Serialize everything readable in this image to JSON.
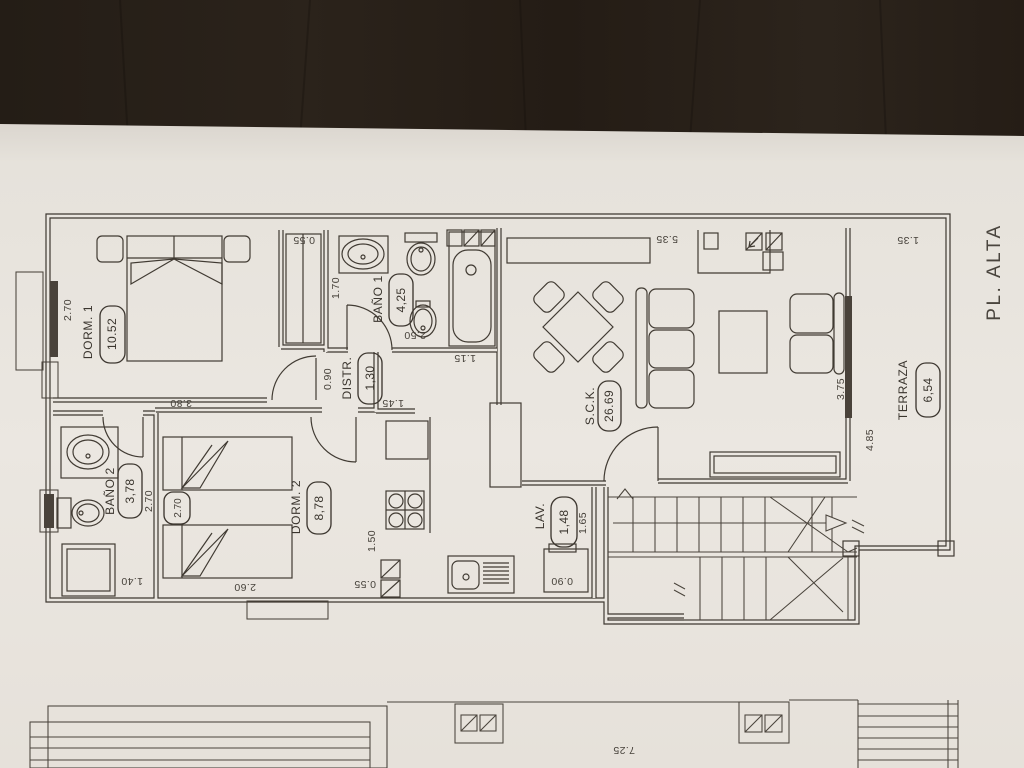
{
  "photo": {
    "desk_color": "#272019",
    "paper_color": "#e9e5df",
    "ink_color": "#3e3831"
  },
  "floor_plan": {
    "floor_label": "PL. ALTA",
    "rooms": [
      {
        "id": "dorm1",
        "name": "DORM. 1",
        "area": "10.52"
      },
      {
        "id": "bano1",
        "name": "BAÑO 1",
        "area": "4,25"
      },
      {
        "id": "distr",
        "name": "DISTR.",
        "area": "1,30"
      },
      {
        "id": "sck",
        "name": "S.C.K.",
        "area": "26.69"
      },
      {
        "id": "terraza",
        "name": "TERRAZA",
        "area": "6,54"
      },
      {
        "id": "bano2",
        "name": "BAÑO 2",
        "area": "3,78"
      },
      {
        "id": "dorm2",
        "name": "DORM. 2",
        "area": "8,78"
      },
      {
        "id": "lav",
        "name": "LAV.",
        "area": "1,48"
      }
    ],
    "dimensions": [
      {
        "id": "dorm1-window",
        "value": "2.70"
      },
      {
        "id": "closet-width",
        "value": "0.55"
      },
      {
        "id": "bano1-depth",
        "value": "1.70"
      },
      {
        "id": "bano1-width",
        "value": "2.50"
      },
      {
        "id": "tub-width",
        "value": "1.15"
      },
      {
        "id": "distr-passage",
        "value": "0.90"
      },
      {
        "id": "kitchen-opening",
        "value": "1.45"
      },
      {
        "id": "sck-width",
        "value": "5.35"
      },
      {
        "id": "terraza-top",
        "value": "1.35"
      },
      {
        "id": "terraza-window",
        "value": "3.75"
      },
      {
        "id": "terraza-depth",
        "value": "4.85"
      },
      {
        "id": "dorm1-length",
        "value": "3.80"
      },
      {
        "id": "bano2-depth",
        "value": "2.70"
      },
      {
        "id": "dorm2-beds",
        "value": "2.70"
      },
      {
        "id": "dorm2-width",
        "value": "2.60"
      },
      {
        "id": "shower-width",
        "value": "1.40"
      },
      {
        "id": "kitchen-depth",
        "value": "1.50"
      },
      {
        "id": "kitchen-nook",
        "value": "0.55"
      },
      {
        "id": "lav-depth",
        "value": "1.65"
      },
      {
        "id": "washer-width",
        "value": "0.90"
      },
      {
        "id": "lower-plan-width",
        "value": "7.25"
      }
    ]
  }
}
